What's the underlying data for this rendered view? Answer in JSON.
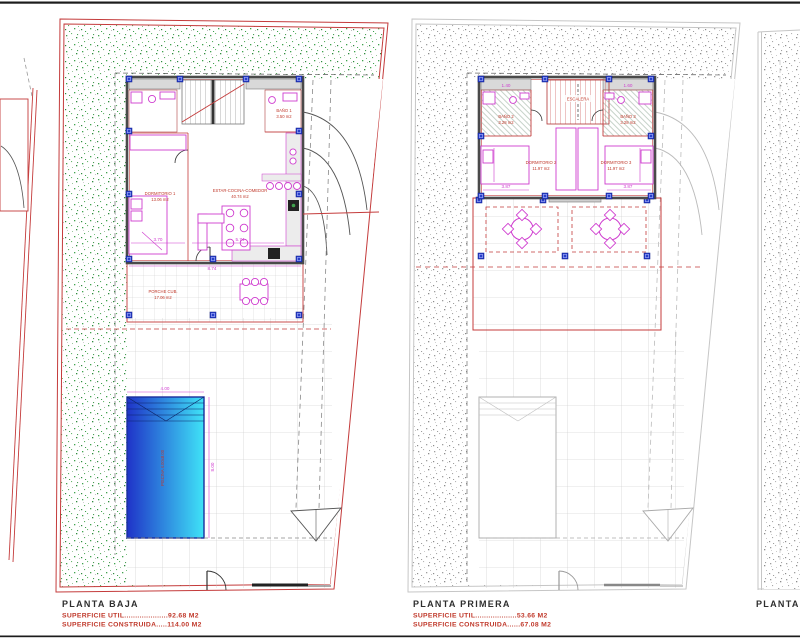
{
  "sheet": {
    "background": "#ffffff"
  },
  "colors": {
    "boundary_red": "#c43b3b",
    "garden_green": "#3fa34d",
    "furniture_magenta": "#cf3ccf",
    "column_blue": "#2940c8",
    "ghost_gray": "#bdbdbd",
    "wall_dark": "#4a4a4a",
    "pool_blue_left": "#1f33c8",
    "pool_cyan_right": "#3fe3f7",
    "label_red": "#c0392b",
    "title_black": "#2e2e2e"
  },
  "planta_baja": {
    "title": "PLANTA BAJA",
    "superficie_util": "SUPERFICIE UTIL....................92.68 M2",
    "superficie_construida": "SUPERFICIE CONSTRUIDA.....114.00 M2",
    "rooms": {
      "dormitorio1": {
        "name": "DORMITORIO 1",
        "area": "13.06 m2"
      },
      "estar": {
        "name": "ESTAR-COCINA-COMEDOR",
        "area": "40.74 m2"
      },
      "bano1": {
        "name": "BAÑO 1",
        "area": "3.50 m2"
      },
      "porche": {
        "name": "PORCHE CUB.",
        "area": "17.06 m2"
      },
      "piscina": {
        "label": "PISCINA 4.00x8.00"
      }
    },
    "dims": {
      "pool_width": "4.00",
      "pool_height": "8.00",
      "porch_width": "8.74",
      "dorm_width": "3.70",
      "living_width": "5.74"
    }
  },
  "planta_primera": {
    "title": "PLANTA PRIMERA",
    "superficie_util": "SUPERFICIE UTIL...................53.66 M2",
    "superficie_construida": "SUPERFICIE CONSTRUIDA......67.08 M2",
    "rooms": {
      "dormitorio2": {
        "name": "DORMITORIO 2",
        "area": "11.97 m2"
      },
      "dormitorio3": {
        "name": "DORMITORIO 3",
        "area": "11.97 m2"
      },
      "bano2": {
        "name": "BAÑO 2",
        "area": "3.28 m2"
      },
      "bano3": {
        "name": "BAÑO 3",
        "area": "3.28 m2"
      },
      "escalera": {
        "name": "ESCALERA"
      }
    },
    "dims": {
      "wing_left": "1.40",
      "wing_right": "1.60",
      "dorm2_width": "3.87",
      "dorm3_width": "3.87"
    }
  },
  "planta_partial": {
    "title": "PLANTA"
  }
}
